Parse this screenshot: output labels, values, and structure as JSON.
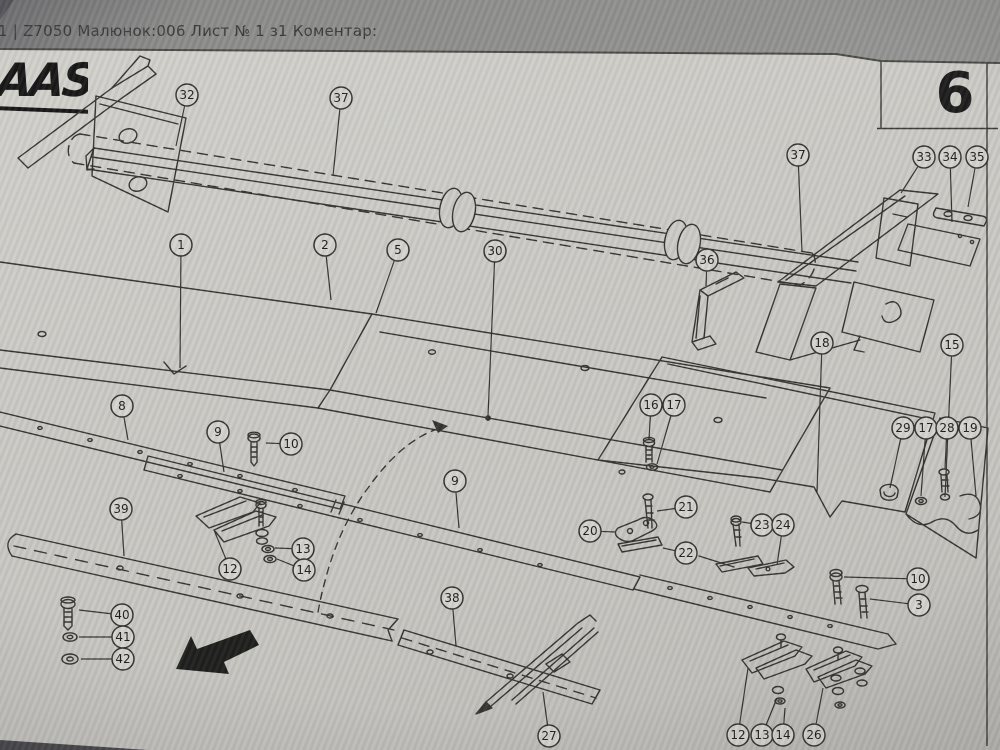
{
  "header": {
    "prefix_fragment": "1 |",
    "title": "Z7050 Малюнок:006 Лист № 1 з1 Коментар:",
    "text_color": "#3b3b3b"
  },
  "page": {
    "logo_text": "CLAAS",
    "logo_visible_part": "AAS",
    "sheet_number": "6",
    "paper_color": "#cbcac5",
    "line_color": "#33332f",
    "highlight_color": "#96a124",
    "selected_part": "18"
  },
  "callouts": [
    {
      "n": "32",
      "x": 187,
      "y": 95,
      "lx": 176,
      "ly": 146
    },
    {
      "n": "37",
      "x": 341,
      "y": 98,
      "lx": 333,
      "ly": 176
    },
    {
      "n": "37",
      "x": 798,
      "y": 155,
      "lx": 802,
      "ly": 252
    },
    {
      "n": "33",
      "x": 924,
      "y": 157,
      "lx": 901,
      "ly": 193
    },
    {
      "n": "34",
      "x": 950,
      "y": 157,
      "lx": 952,
      "ly": 222
    },
    {
      "n": "35",
      "x": 977,
      "y": 157,
      "lx": 968,
      "ly": 207
    },
    {
      "n": "1",
      "x": 181,
      "y": 245,
      "lx": 180,
      "ly": 368
    },
    {
      "n": "2",
      "x": 325,
      "y": 245,
      "lx": 331,
      "ly": 300
    },
    {
      "n": "5",
      "x": 398,
      "y": 250,
      "lx": 376,
      "ly": 313
    },
    {
      "n": "30",
      "x": 495,
      "y": 251,
      "lx": 488,
      "ly": 416
    },
    {
      "n": "36",
      "x": 707,
      "y": 260,
      "lx": 706,
      "ly": 286
    },
    {
      "n": "18",
      "x": 822,
      "y": 343,
      "highlight": true,
      "lx": 817,
      "ly": 492
    },
    {
      "n": "15",
      "x": 952,
      "y": 345,
      "lx": 945,
      "ly": 497
    },
    {
      "n": "8",
      "x": 122,
      "y": 406,
      "lx": 128,
      "ly": 440
    },
    {
      "n": "9",
      "x": 218,
      "y": 432,
      "lx": 224,
      "ly": 472
    },
    {
      "n": "10",
      "x": 291,
      "y": 444,
      "lx": 266,
      "ly": 443
    },
    {
      "n": "16",
      "x": 651,
      "y": 405,
      "lx": 649,
      "ly": 439
    },
    {
      "n": "17",
      "x": 674,
      "y": 405,
      "lx": 657,
      "ly": 464
    },
    {
      "n": "29",
      "x": 903,
      "y": 428,
      "lx": 890,
      "ly": 488
    },
    {
      "n": "17",
      "x": 926,
      "y": 428,
      "lx": 921,
      "ly": 496
    },
    {
      "n": "28",
      "x": 947,
      "y": 428,
      "lx": 945,
      "ly": 469
    },
    {
      "n": "19",
      "x": 970,
      "y": 428,
      "lx": 976,
      "ly": 496
    },
    {
      "n": "39",
      "x": 121,
      "y": 509,
      "lx": 124,
      "ly": 556
    },
    {
      "n": "12",
      "x": 230,
      "y": 569,
      "lx": 214,
      "ly": 530
    },
    {
      "n": "13",
      "x": 303,
      "y": 549,
      "lx": 275,
      "ly": 548
    },
    {
      "n": "14",
      "x": 304,
      "y": 570,
      "lx": 277,
      "ly": 559
    },
    {
      "n": "9",
      "x": 455,
      "y": 481,
      "lx": 459,
      "ly": 528
    },
    {
      "n": "20",
      "x": 590,
      "y": 531,
      "lx": 616,
      "ly": 532
    },
    {
      "n": "21",
      "x": 686,
      "y": 507,
      "lx": 657,
      "ly": 511
    },
    {
      "n": "22",
      "x": 686,
      "y": 553,
      "lx": 663,
      "ly": 548
    },
    {
      "n": "23",
      "x": 762,
      "y": 525,
      "lx": 742,
      "ly": 522
    },
    {
      "n": "24",
      "x": 783,
      "y": 525,
      "lx": 777,
      "ly": 565
    },
    {
      "n": "38",
      "x": 452,
      "y": 598,
      "lx": 456,
      "ly": 646
    },
    {
      "n": "10",
      "x": 918,
      "y": 579,
      "lx": 844,
      "ly": 577
    },
    {
      "n": "3",
      "x": 919,
      "y": 605,
      "lx": 870,
      "ly": 599
    },
    {
      "n": "40",
      "x": 122,
      "y": 615,
      "lx": 79,
      "ly": 610
    },
    {
      "n": "41",
      "x": 123,
      "y": 637,
      "lx": 79,
      "ly": 637
    },
    {
      "n": "42",
      "x": 123,
      "y": 659,
      "lx": 81,
      "ly": 659
    },
    {
      "n": "27",
      "x": 549,
      "y": 736,
      "lx": 543,
      "ly": 692
    },
    {
      "n": "12",
      "x": 738,
      "y": 735,
      "lx": 748,
      "ly": 668
    },
    {
      "n": "13",
      "x": 762,
      "y": 735,
      "lx": 777,
      "ly": 698
    },
    {
      "n": "14",
      "x": 783,
      "y": 735,
      "lx": 785,
      "ly": 708
    },
    {
      "n": "26",
      "x": 814,
      "y": 735,
      "lx": 823,
      "ly": 688
    }
  ]
}
